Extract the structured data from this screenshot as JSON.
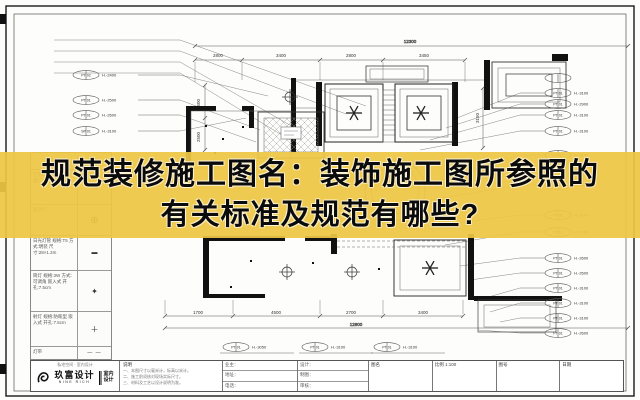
{
  "banner": {
    "line1": "规范装修施工图名：装饰施工图所参照的",
    "line2": "有关标准及规范有哪些?",
    "bg_color": "#eec644",
    "text_color": "#0b0b0b"
  },
  "legend": {
    "col_name": "名称",
    "col_symbol": "图例",
    "rows": [
      {
        "name": "艺术玻璃 / 银镜(墙面)",
        "symbol": "▤"
      },
      {
        "name": "吸顶灯",
        "symbol": "⊕"
      },
      {
        "name": "日光灯管 规格:T5 方式:明装 尺寸:28×1.2m",
        "symbol": "▬"
      },
      {
        "name": "筒灯 规格:3W 方式:可调角 嵌入式 开孔:7.5cm",
        "symbol": "✦"
      },
      {
        "name": "射灯 规格:防眩型 嵌入式 开孔:7.5cm",
        "symbol": "＋"
      },
      {
        "name": "灯带",
        "symbol": "— —"
      }
    ]
  },
  "plan": {
    "dims_top": {
      "overall": "12300",
      "segments": [
        {
          "x": 218,
          "y": 57,
          "label": "2800"
        },
        {
          "x": 281,
          "y": 57,
          "label": "3400"
        },
        {
          "x": 351,
          "y": 57,
          "label": "2800"
        },
        {
          "x": 424,
          "y": 57,
          "label": "3450"
        }
      ]
    },
    "dims_bottom": {
      "overall": "12800",
      "segments": [
        {
          "x": 198,
          "y": 314,
          "label": "1700"
        },
        {
          "x": 276,
          "y": 314,
          "label": "4500"
        },
        {
          "x": 351,
          "y": 314,
          "label": "2700"
        },
        {
          "x": 423,
          "y": 314,
          "label": "3400"
        }
      ]
    },
    "vdims": [
      {
        "x": 200,
        "y": 104,
        "label": "1500"
      },
      {
        "x": 200,
        "y": 137,
        "label": "2500"
      },
      {
        "x": 479,
        "y": 118,
        "label": "3150"
      }
    ],
    "callouts_left": [
      {
        "x": 86,
        "y": 75,
        "tag": "PT 02",
        "h": "H.-2400"
      },
      {
        "x": 86,
        "y": 100,
        "tag": "PT 01",
        "h": "H.-2500"
      },
      {
        "x": 86,
        "y": 115,
        "tag": "PT 01",
        "h": "H.-2600"
      },
      {
        "x": 86,
        "y": 131,
        "tag": "SP 01",
        "h": "H.-3100"
      }
    ],
    "callouts_right": [
      {
        "x": 558,
        "y": 93,
        "tag": "PT 01",
        "h": "H.-3100"
      },
      {
        "x": 558,
        "y": 104,
        "tag": "PT 01",
        "h": "H.-2900"
      },
      {
        "x": 558,
        "y": 115,
        "tag": "PT 01",
        "h": "H.-3100"
      },
      {
        "x": 558,
        "y": 131,
        "tag": "PT 01",
        "h": "H.-3100"
      },
      {
        "x": 558,
        "y": 155,
        "tag": "PT 01",
        "h": "H.-3100"
      },
      {
        "x": 558,
        "y": 185,
        "tag": "PT 01",
        "h": "H.-2900"
      },
      {
        "x": 558,
        "y": 215,
        "tag": "PT 01",
        "h": "H.-3100"
      },
      {
        "x": 558,
        "y": 232,
        "tag": "PT 01",
        "h": "H.-3000"
      },
      {
        "x": 558,
        "y": 258,
        "tag": "PT 01",
        "h": "H.-2600"
      },
      {
        "x": 558,
        "y": 273,
        "tag": "PT 01",
        "h": "H.-2600"
      },
      {
        "x": 558,
        "y": 288,
        "tag": "PT 01",
        "h": "H.-3100"
      },
      {
        "x": 558,
        "y": 303,
        "tag": "PT 01",
        "h": "H.-3100"
      },
      {
        "x": 558,
        "y": 318,
        "tag": "PT 01",
        "h": "H.-3100"
      },
      {
        "x": 558,
        "y": 333,
        "tag": "PT 01",
        "h": "H.-2600"
      }
    ],
    "callouts_bottom": [
      {
        "x": 236,
        "y": 347,
        "tag": "PT 01",
        "h": "H.-3050"
      },
      {
        "x": 315,
        "y": 347,
        "tag": "PT 01",
        "h": "H.-3100"
      },
      {
        "x": 387,
        "y": 347,
        "tag": "PT 01",
        "h": "H.-3100"
      }
    ]
  },
  "title_block": {
    "top_note": "私宅空间 · 室内设计",
    "brand_cn": "玖富设计",
    "brand_en": "NINE RICH",
    "brand_side1": "室内",
    "brand_side2": "设计",
    "desc_label": "说明",
    "desc_lines": [
      {
        "text": "一、本图尺寸以毫米计，标高以米计。"
      },
      {
        "text": "二、施工前须核对现场实际尺寸。"
      },
      {
        "text": "三、材料及工艺以设计说明为准。"
      }
    ],
    "col_a": [
      {
        "text": "业主："
      },
      {
        "text": "地址："
      },
      {
        "text": "电话："
      }
    ],
    "col_b": [
      {
        "text": "设计："
      },
      {
        "text": "制图："
      },
      {
        "text": "审核："
      }
    ],
    "cells": [
      {
        "label": "图名",
        "value": ""
      },
      {
        "label": "比例",
        "value": "1:100"
      },
      {
        "label": "图号",
        "value": ""
      },
      {
        "label": "日期",
        "value": ""
      }
    ]
  }
}
